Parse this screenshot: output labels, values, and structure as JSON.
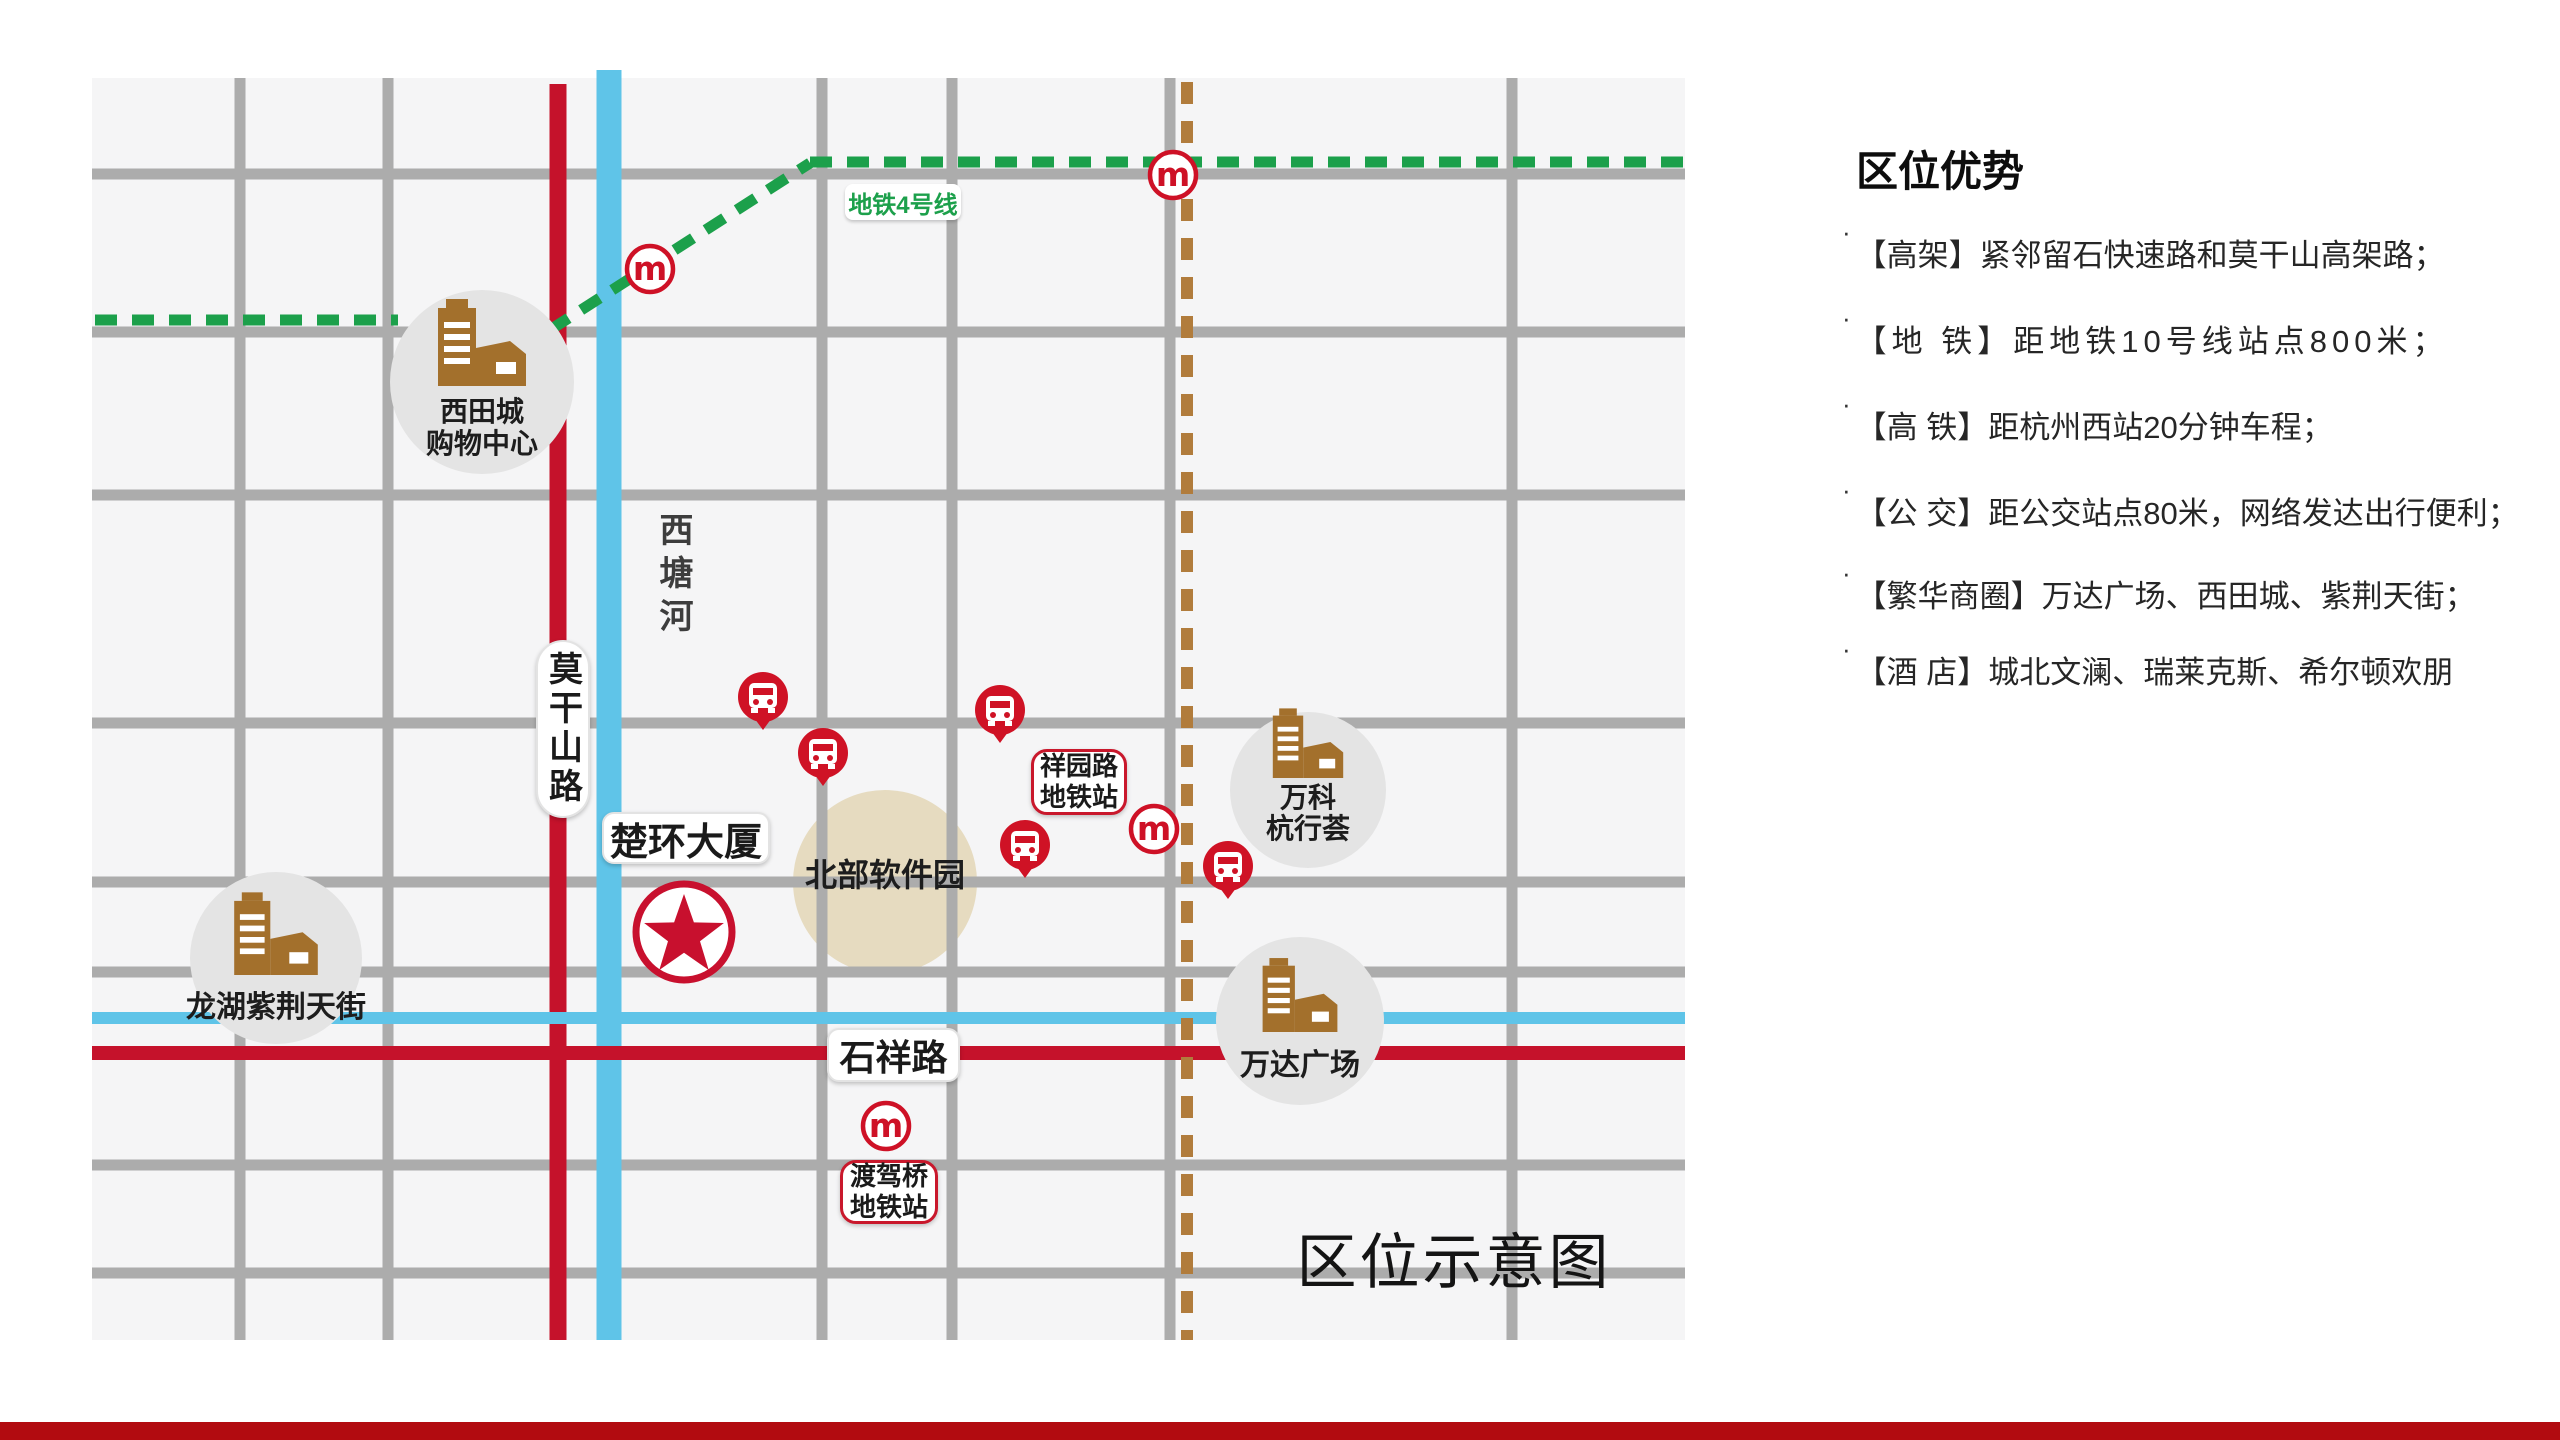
{
  "panel": {
    "title": "区位优势",
    "bullet_marker": "·",
    "bullets": [
      {
        "text": "【高架】紧邻留石快速路和莫干山高架路；"
      },
      {
        "text": "【地 铁】距地铁10号线站点800米；"
      },
      {
        "text": "【高 铁】距杭州西站20分钟车程；"
      },
      {
        "text": "【公 交】距公交站点80米，网络发达出行便利；"
      },
      {
        "text": "【繁华商圈】万达广场、西田城、紫荆天街；"
      },
      {
        "text": "【酒  店】城北文澜、瑞莱克斯、希尔顿欢朋"
      }
    ]
  },
  "map": {
    "caption": "区位示意图",
    "metro_line_label": "地铁4号线",
    "project_label": "楚环大厦",
    "roads": {
      "mogangshan_road": "莫干山路",
      "shixiang_road": "石祥路",
      "xitang_river": "西塘河"
    },
    "stations": {
      "xiangyuan": {
        "line1": "祥园路",
        "line2": "地铁站"
      },
      "dujiaqiao": {
        "line1": "渡驾桥",
        "line2": "地铁站"
      }
    },
    "landmarks": {
      "xitiancheng": {
        "line1": "西田城",
        "line2": "购物中心"
      },
      "longhu": "龙湖紫荆天街",
      "software_park": "北部软件园",
      "vanke": {
        "line1": "万科",
        "line2": "杭行荟"
      },
      "wanda": "万达广场"
    }
  },
  "icons": {
    "metro_glyph": "m"
  },
  "colors": {
    "accent_red": "#C8102E",
    "map_red_road": "#C5122B",
    "river_blue": "#5FC4E8",
    "metro_green": "#1CA04B",
    "dash_brown": "#B17C3C",
    "road_gray": "#ACACAC",
    "landmark_gray": "#E4E4E4",
    "landmark_tan": "#E6DBC0",
    "building_brown": "#A3702C",
    "bottom_bar": "#B20B10"
  }
}
